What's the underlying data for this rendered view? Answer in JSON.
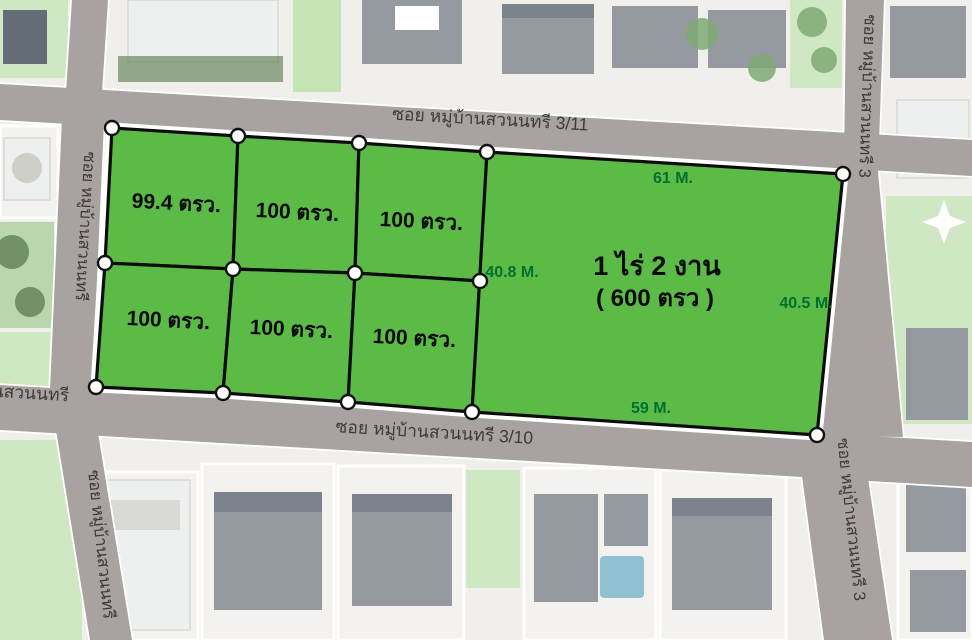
{
  "streets": {
    "top": "ซอย หมู่บ้านสวนนทรี 3/11",
    "bottom": "ซอย หมู่บ้านสวนนทรี 3/10",
    "left_upper": "ซอย หมู่บ้านสวนนทรี",
    "left_lower": "ซอย หมู่บ้านสวนนทรี",
    "left_corner_partial": "นสวนนทรี",
    "right_upper": "ซอย หมู่บ้านสวนนทรี 3",
    "right_lower": "ซอย หมู่บ้านสวนนทรี 3"
  },
  "plots": [
    {
      "label": "99.4 ตรว."
    },
    {
      "label": "100 ตรว."
    },
    {
      "label": "100 ตรว."
    },
    {
      "label": "100 ตรว."
    },
    {
      "label": "100 ตรว."
    },
    {
      "label": "100 ตรว."
    }
  ],
  "big_plot": {
    "line1": "1 ไร่ 2 งาน",
    "line2": "( 600 ตรว )"
  },
  "measurements": {
    "top": "61 M.",
    "left": "40.8 M.",
    "right": "40.5 M.",
    "bottom": "59 M."
  },
  "colors": {
    "plot_green": "#5cbb47",
    "plot_border": "#0c0c0c",
    "measure_text": "#00702e",
    "road_gray": "#a8a3a1",
    "road_text": "#3e3a38"
  }
}
